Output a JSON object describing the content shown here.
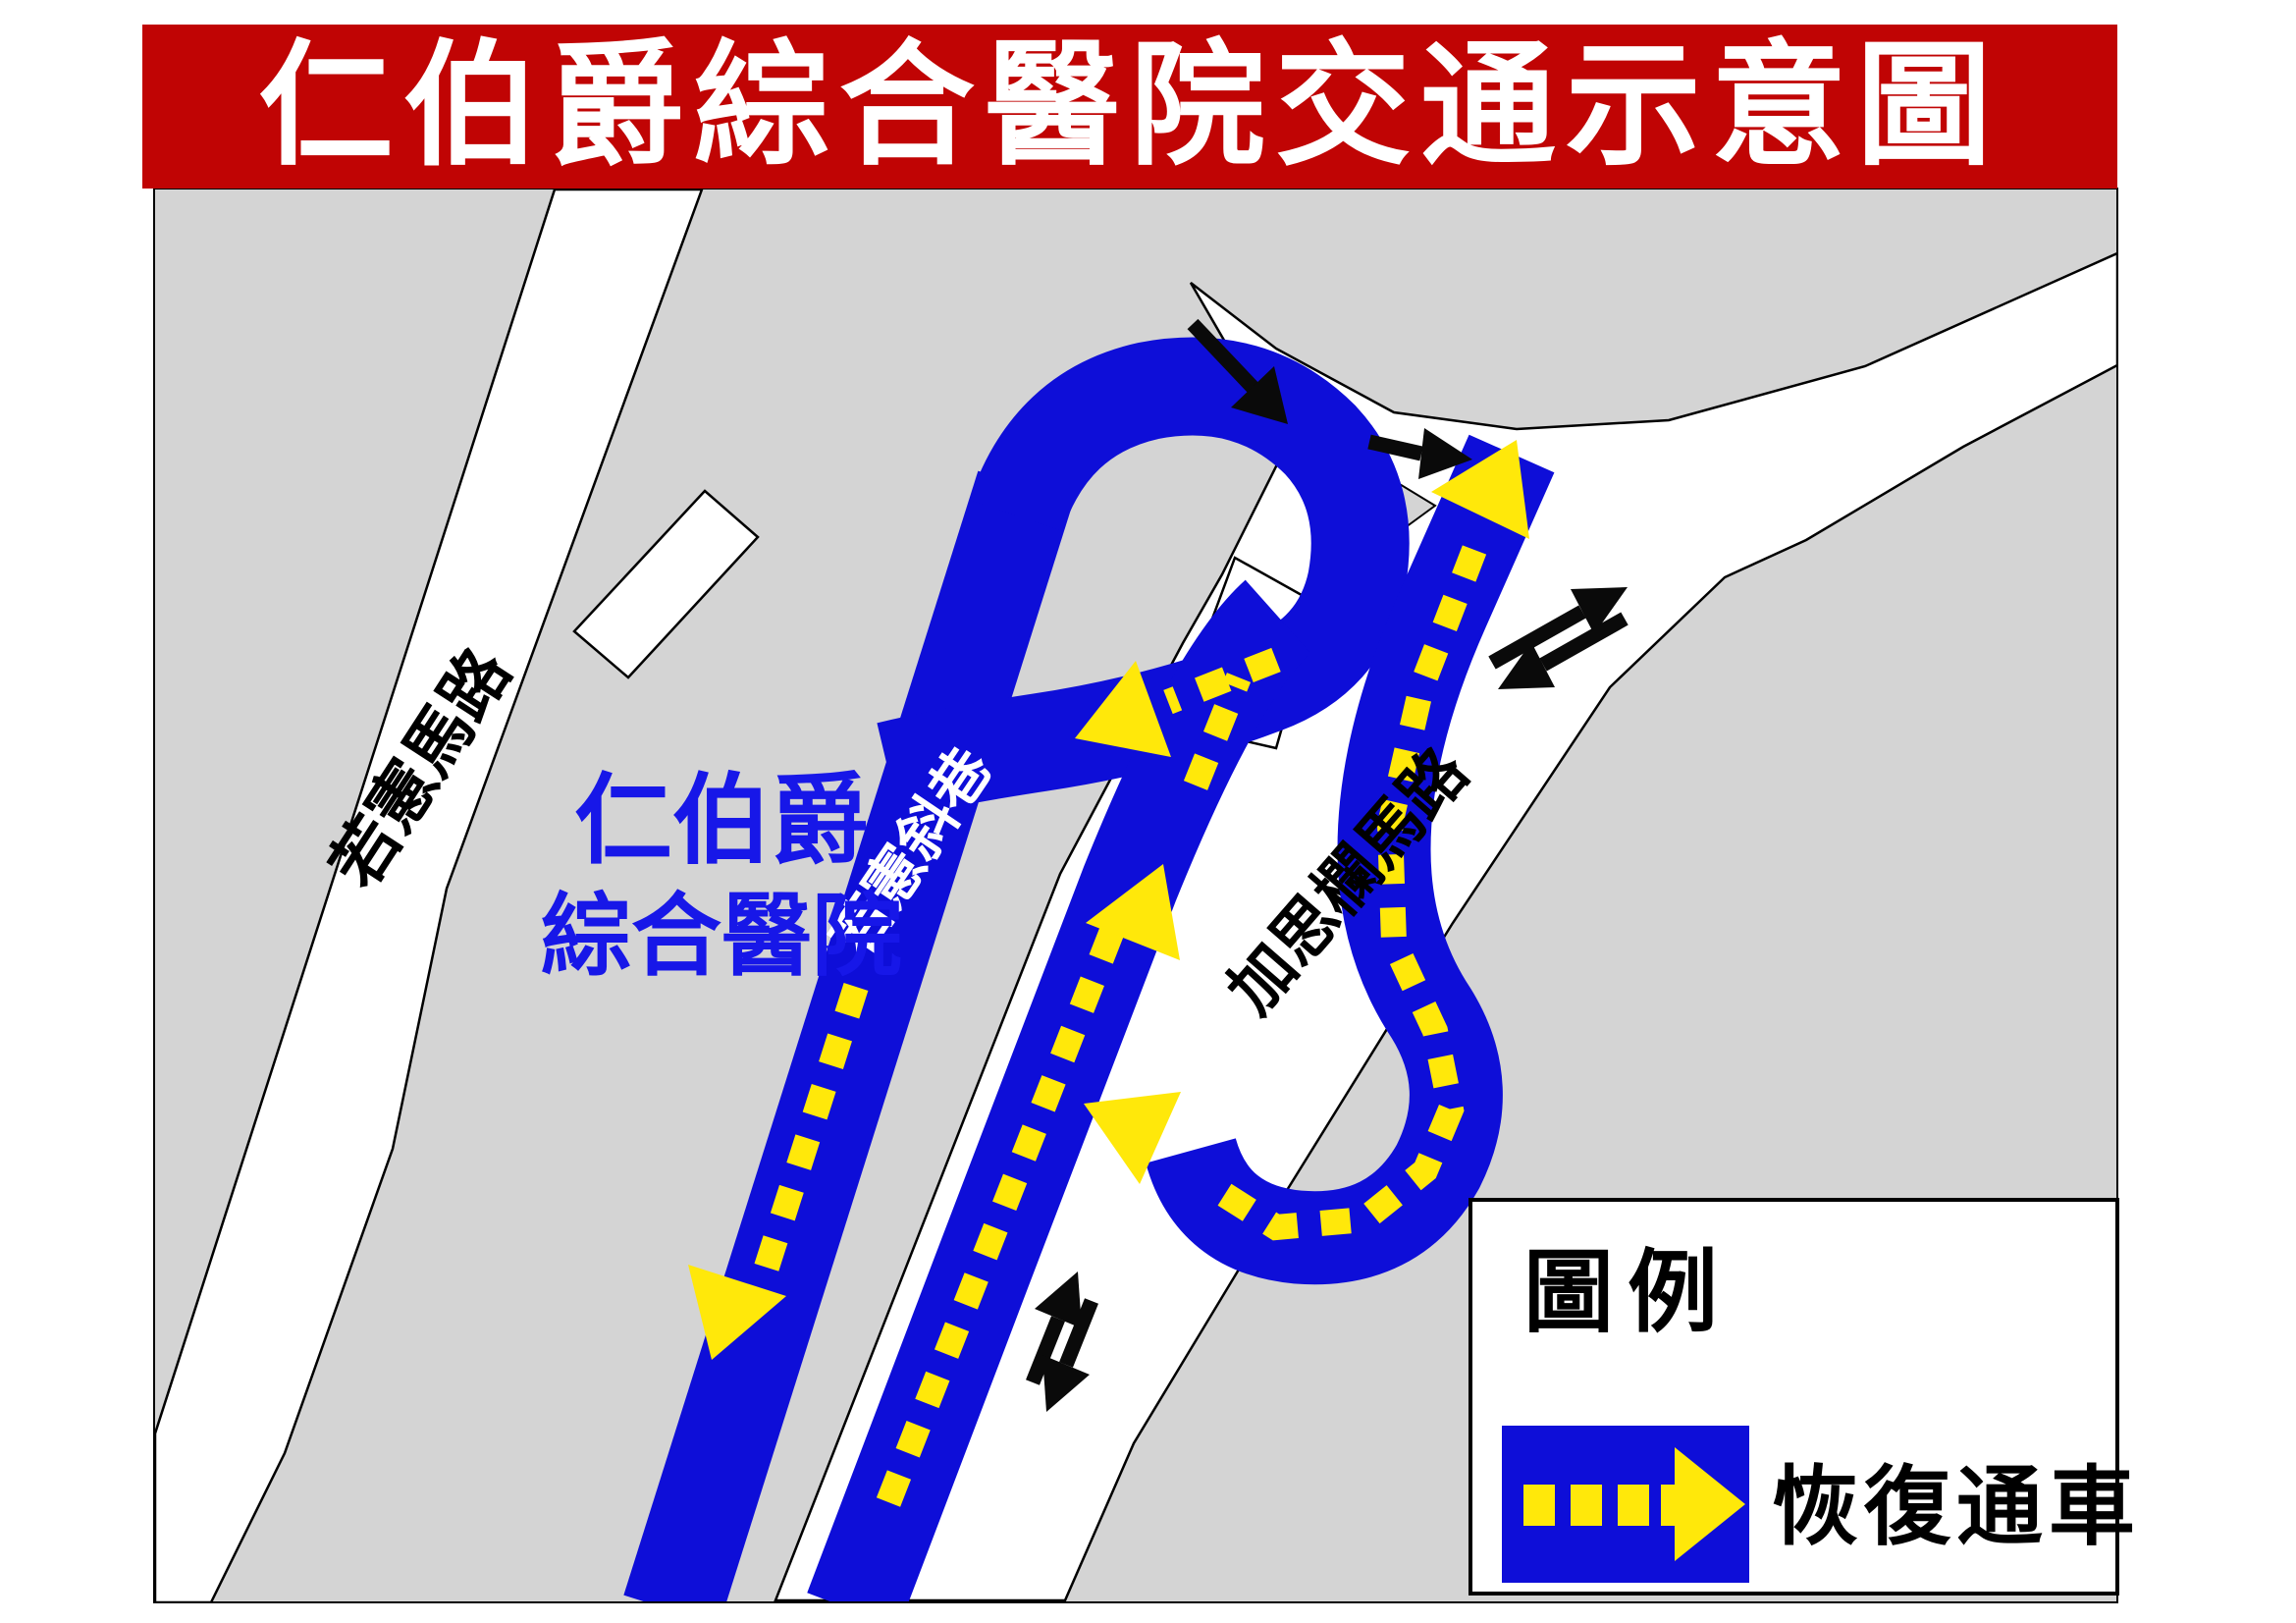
{
  "banner": {
    "title": "仁伯爵綜合醫院交通示意圖"
  },
  "colors": {
    "banner_red": "#c00404",
    "map_gray": "#d4d4d4",
    "road_white": "#ffffff",
    "resumed_blue": "#0e0ed8",
    "arrow_yellow": "#ffe80a",
    "hospital_label_blue": "#1717e8",
    "outline_black": "#000000"
  },
  "map": {
    "labels": {
      "road_top_left": "若憲馬路",
      "road_blue_lane": "若憲斜巷",
      "road_right": "加思欄馬路",
      "hospital_line1": "仁伯爵",
      "hospital_line2": "綜合醫院"
    },
    "icons": {
      "yellow_dashed_arrow": "resumed-traffic-direction",
      "black_arrow": "normal-traffic-direction"
    }
  },
  "legend": {
    "title": "圖例",
    "items": [
      {
        "symbol": "blue-band-yellow-dashed-arrow",
        "label": "恢復通車"
      }
    ]
  }
}
